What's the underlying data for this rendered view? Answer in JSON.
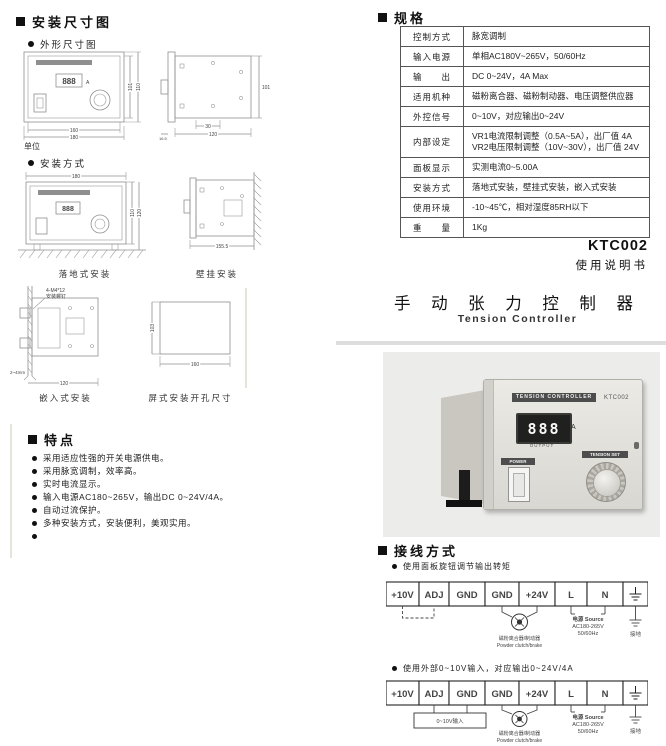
{
  "left": {
    "dim_section": "安装尺寸图",
    "outline_sub": "外形尺寸图",
    "unit_note": "单位",
    "install_sub": "安装方式",
    "outline_front": {
      "display": "888",
      "amp": "A",
      "dim_w_inner": "160",
      "dim_w_outer": "180",
      "dim_h_inner": "101",
      "dim_h_outer": "110"
    },
    "outline_side": {
      "dim_h": "101",
      "dim_hole": "30",
      "dim_d": "120",
      "dim_flange": "16.5"
    },
    "floor": {
      "caption": "落地式安装",
      "display": "888",
      "dim_w": "180",
      "dim_h1": "110",
      "dim_h2": "120"
    },
    "wall": {
      "caption": "壁挂安装",
      "dim_d": "155.5"
    },
    "flush": {
      "caption": "嵌入式安装",
      "screw_note1": "4-M4*12",
      "screw_note2": "安装螺钉",
      "gap_note": "2~4mm",
      "dim_d": "120"
    },
    "cutout": {
      "caption": "屏式安装开孔尺寸",
      "dim_h": "103",
      "dim_w": "160"
    },
    "features": {
      "title": "特点",
      "items": [
        "采用适应性强的开关电源供电。",
        "采用脉宽调制，效率高。",
        "实时电流显示。",
        "输入电源AC180~265V，输出DC 0~24V/4A。",
        "自动过流保护。",
        "多种安装方式，安装便利，美观实用。",
        ""
      ]
    }
  },
  "right": {
    "spec_title": "规格",
    "spec_rows": [
      {
        "label": "控制方式",
        "value": "脉宽调制"
      },
      {
        "label": "输入电源",
        "value": "单相AC180V~265V，50/60Hz"
      },
      {
        "label": "输　　出",
        "value": "DC 0~24V，4A Max"
      },
      {
        "label": "适用机种",
        "value": "磁粉离合器、磁粉制动器、电压调整供应器"
      },
      {
        "label": "外控信号",
        "value": "0~10V，对应输出0~24V"
      },
      {
        "label": "内部设定",
        "value": "VR1电流限制调整（0.5A~5A），出厂值 4A",
        "value2": "VR2电压限制调整（10V~30V），出厂值 24V"
      },
      {
        "label": "面板显示",
        "value": "实测电流0~5.00A"
      },
      {
        "label": "安装方式",
        "value": "落地式安装，壁挂式安装，嵌入式安装"
      },
      {
        "label": "使用环境",
        "value": "-10~45℃，相对湿度85RH以下"
      },
      {
        "label": "重　　量",
        "value": "1Kg"
      }
    ],
    "model": "KTC002",
    "manual": "使用说明书",
    "title_cn": "手 动 张 力 控 制 器",
    "title_en": "Tension Controller",
    "photo": {
      "brand": "TENSION CONTROLLER",
      "model": "KTC002",
      "display": "888",
      "amp": "A",
      "output": "OUTPUT",
      "power": "POWER",
      "knob": "TENSION SET"
    },
    "wiring": {
      "title": "接线方式",
      "note1": "使用面板旋钮调节输出转矩",
      "note2": "使用外部0~10V输入，对应输出0~24V/4A",
      "t1": "+10V",
      "t2": "ADJ",
      "t3": "GND",
      "t4": "GND",
      "t5": "+24V",
      "t6": "L",
      "t7": "N",
      "clutch_cn": "磁粉离合器/制动器",
      "clutch_en": "Powder clutch/brake",
      "src1": "电源 Source",
      "src2": "AC180-265V",
      "src3": "50/60Hz",
      "earth": "接地",
      "ext": "0~10V输入"
    }
  }
}
